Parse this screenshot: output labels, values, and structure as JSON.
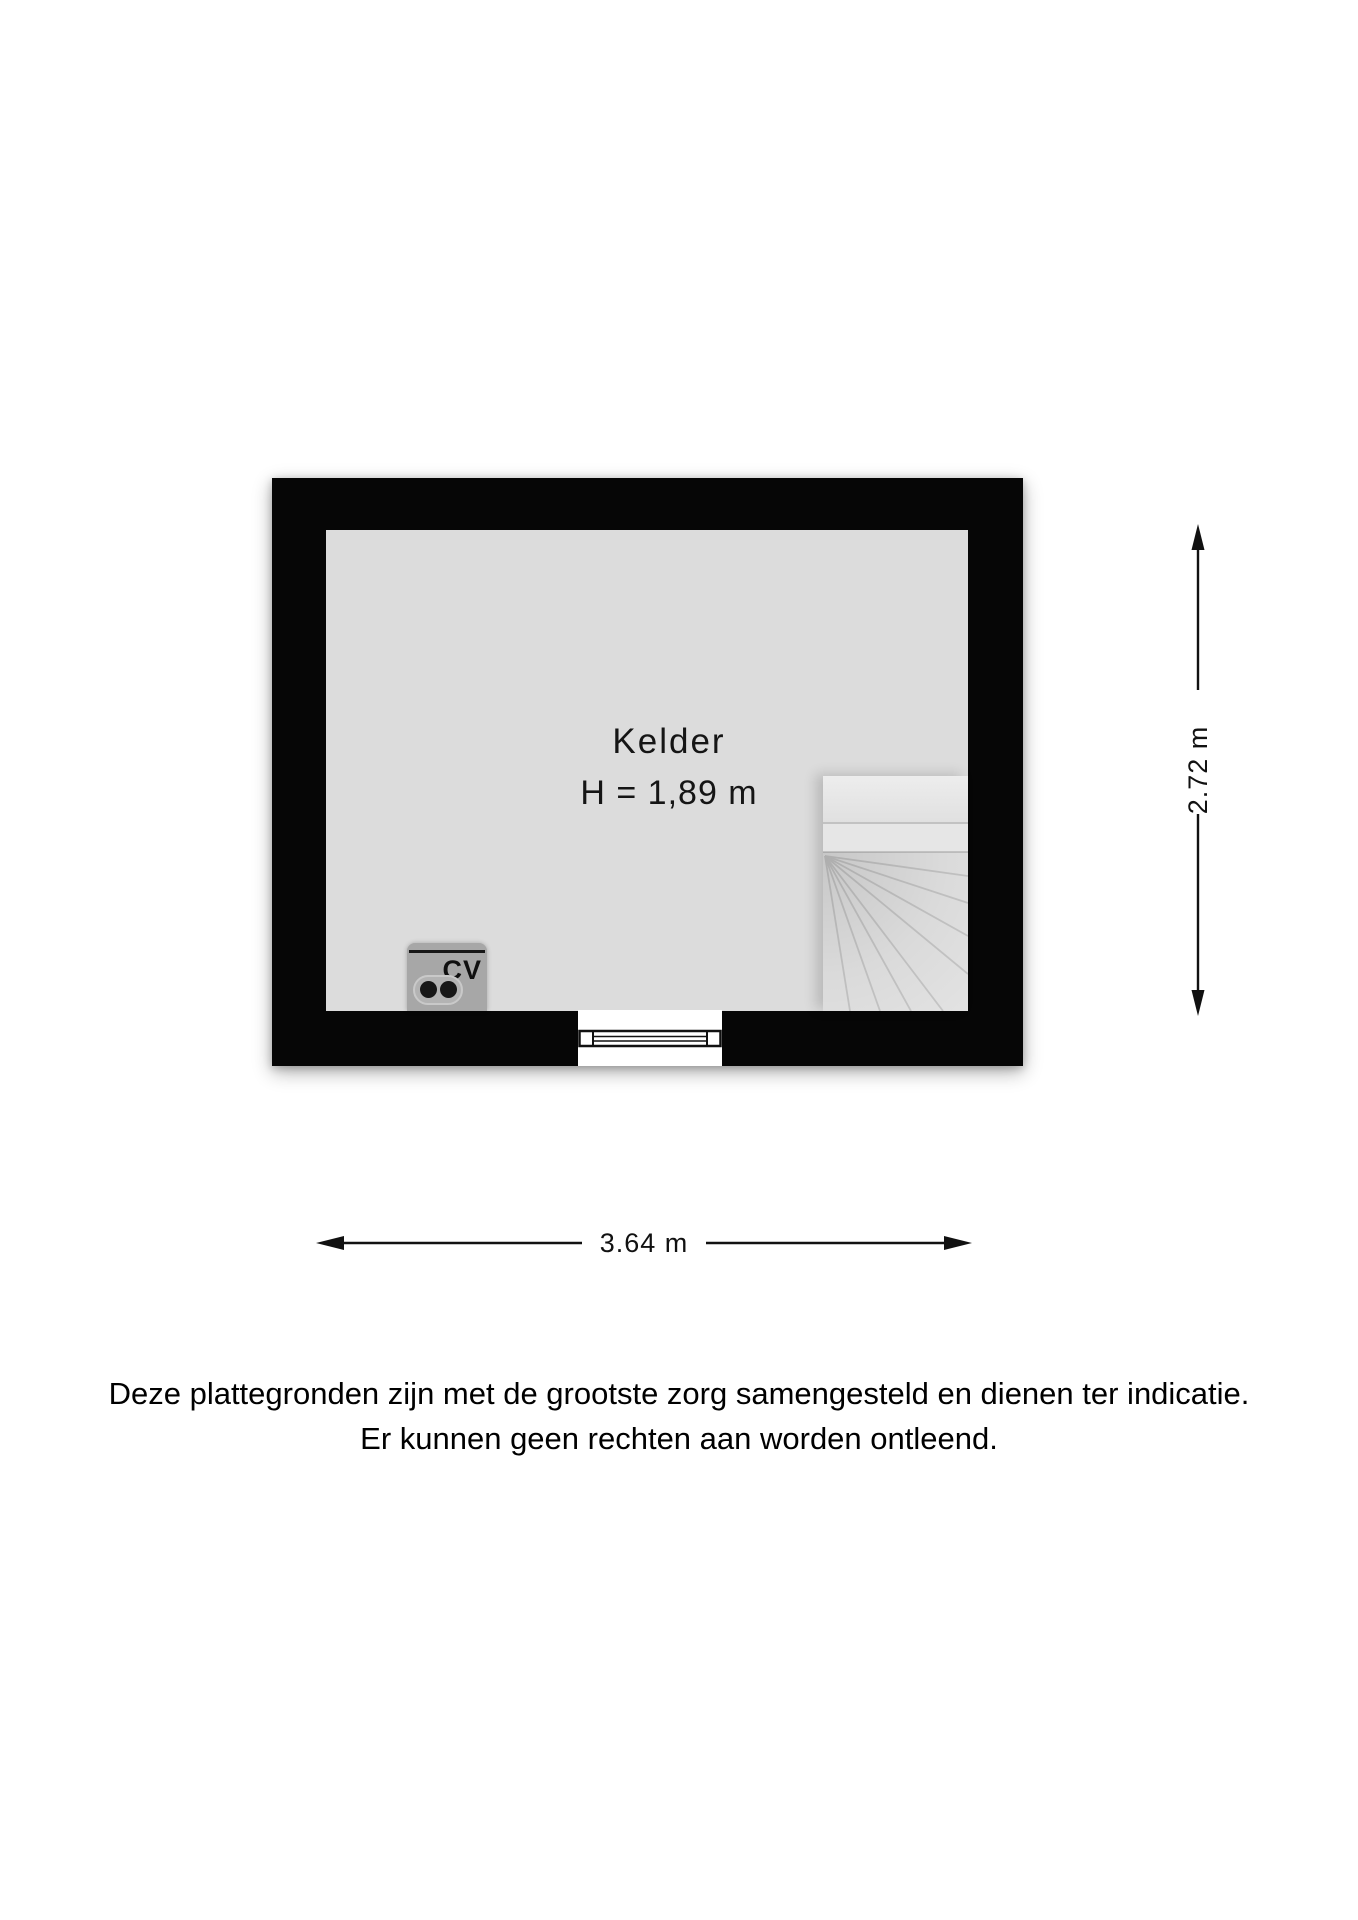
{
  "floorplan": {
    "room": {
      "label": "Kelder",
      "height_label": "H = 1,89 m"
    },
    "cv": {
      "label": "CV"
    },
    "dimensions": {
      "vertical": "2.72 m",
      "horizontal": "3.64 m"
    },
    "colors": {
      "wall": "#060606",
      "floor": "#dcdcdc",
      "stairs": "#e3e3e3",
      "window_frame": "#111111",
      "cv_unit": "#a7a7a7",
      "dimension_lines": "#111111"
    }
  },
  "disclaimer": {
    "line1": "Deze plattegronden zijn met de grootste zorg samengesteld en dienen ter indicatie.",
    "line2": "Er kunnen geen rechten aan worden ontleend."
  }
}
